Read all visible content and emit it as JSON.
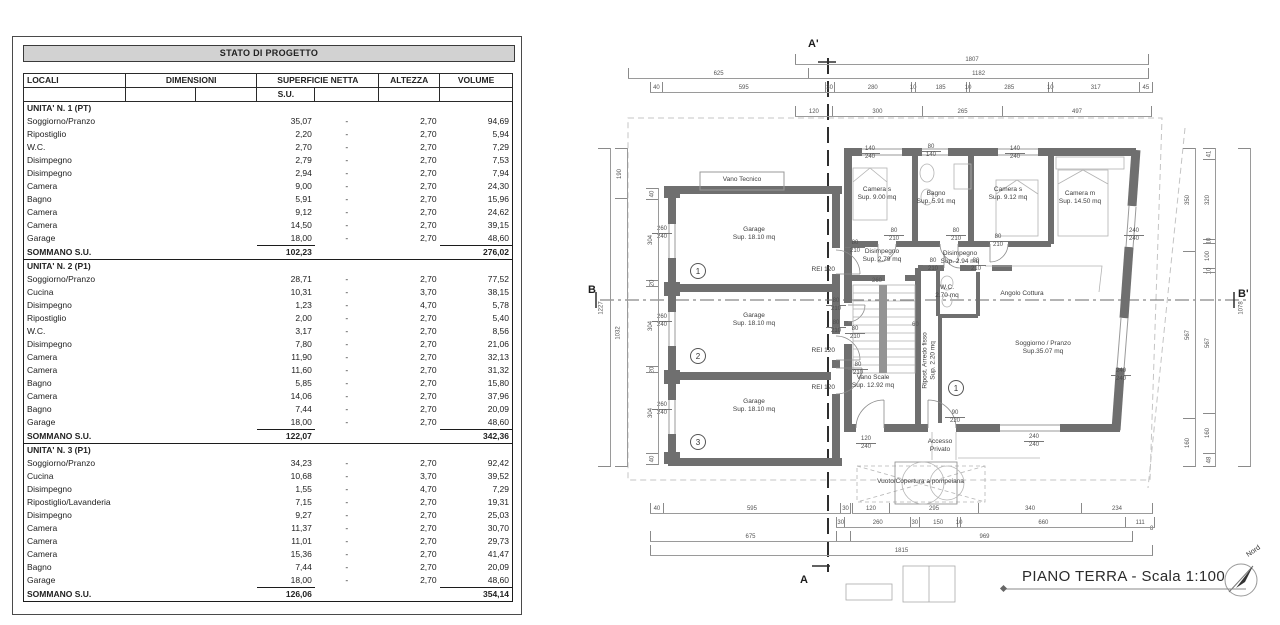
{
  "colors": {
    "wall": "#6f6f6f",
    "table_header_bg": "#d2d2d2",
    "boundary": "#c4c4c4"
  },
  "table": {
    "title": "STATO DI PROGETTO",
    "headers": {
      "locali": "LOCALI",
      "dimensioni": "DIMENSIONI",
      "superficie": "SUPERFICIE NETTA",
      "su": "S.U.",
      "altezza": "ALTEZZA",
      "volume": "VOLUME",
      "sommano": "SOMMANO S.U."
    },
    "groups": [
      {
        "name": "UNITA' N. 1 (PT)",
        "rows": [
          [
            "Soggiorno/Pranzo",
            "35,07",
            "-",
            "2,70",
            "94,69"
          ],
          [
            "Ripostiglio",
            "2,20",
            "-",
            "2,70",
            "5,94"
          ],
          [
            "W.C.",
            "2,70",
            "-",
            "2,70",
            "7,29"
          ],
          [
            "Disimpegno",
            "2,79",
            "-",
            "2,70",
            "7,53"
          ],
          [
            "Disimpegno",
            "2,94",
            "-",
            "2,70",
            "7,94"
          ],
          [
            "Camera",
            "9,00",
            "-",
            "2,70",
            "24,30"
          ],
          [
            "Bagno",
            "5,91",
            "-",
            "2,70",
            "15,96"
          ],
          [
            "Camera",
            "9,12",
            "-",
            "2,70",
            "24,62"
          ],
          [
            "Camera",
            "14,50",
            "-",
            "2,70",
            "39,15"
          ],
          [
            "Garage",
            "18,00",
            "-",
            "2,70",
            "48,60"
          ]
        ],
        "total_su": "102,23",
        "total_volume": "276,02"
      },
      {
        "name": "UNITA' N. 2 (P1)",
        "rows": [
          [
            "Soggiorno/Pranzo",
            "28,71",
            "-",
            "2,70",
            "77,52"
          ],
          [
            "Cucina",
            "10,31",
            "-",
            "3,70",
            "38,15"
          ],
          [
            "Disimpegno",
            "1,23",
            "-",
            "4,70",
            "5,78"
          ],
          [
            "Ripostiglio",
            "2,00",
            "-",
            "2,70",
            "5,40"
          ],
          [
            "W.C.",
            "3,17",
            "-",
            "2,70",
            "8,56"
          ],
          [
            "Disimpegno",
            "7,80",
            "-",
            "2,70",
            "21,06"
          ],
          [
            "Camera",
            "11,90",
            "-",
            "2,70",
            "32,13"
          ],
          [
            "Camera",
            "11,60",
            "-",
            "2,70",
            "31,32"
          ],
          [
            "Bagno",
            "5,85",
            "-",
            "2,70",
            "15,80"
          ],
          [
            "Camera",
            "14,06",
            "-",
            "2,70",
            "37,96"
          ],
          [
            "Bagno",
            "7,44",
            "-",
            "2,70",
            "20,09"
          ],
          [
            "Garage",
            "18,00",
            "-",
            "2,70",
            "48,60"
          ]
        ],
        "total_su": "122,07",
        "total_volume": "342,36"
      },
      {
        "name": "UNITA' N. 3 (P1)",
        "rows": [
          [
            "Soggiorno/Pranzo",
            "34,23",
            "-",
            "2,70",
            "92,42"
          ],
          [
            "Cucina",
            "10,68",
            "-",
            "3,70",
            "39,52"
          ],
          [
            "Disimpegno",
            "1,55",
            "-",
            "4,70",
            "7,29"
          ],
          [
            "Ripostiglio/Lavanderia",
            "7,15",
            "-",
            "2,70",
            "19,31"
          ],
          [
            "Disimpegno",
            "9,27",
            "-",
            "2,70",
            "25,03"
          ],
          [
            "Camera",
            "11,37",
            "-",
            "2,70",
            "30,70"
          ],
          [
            "Camera",
            "11,01",
            "-",
            "2,70",
            "29,73"
          ],
          [
            "Camera",
            "15,36",
            "-",
            "2,70",
            "41,47"
          ],
          [
            "Bagno",
            "7,44",
            "-",
            "2,70",
            "20,09"
          ],
          [
            "Garage",
            "18,00",
            "-",
            "2,70",
            "48,60"
          ]
        ],
        "total_su": "126,06",
        "total_volume": "354,14"
      }
    ]
  },
  "plan": {
    "title": "PIANO TERRA - Scala 1:100",
    "north": "Nord",
    "markers": {
      "a_top": "A'",
      "a_bottom": "A",
      "b_left": "B",
      "b_right": "B'"
    },
    "fire_label": "REI 120",
    "unit_badges": [
      "1",
      "2",
      "3"
    ],
    "entry_badge": "1",
    "rooms": [
      {
        "name": "Camera s",
        "sup": "Sup. 9.00 mq"
      },
      {
        "name": "Bagno",
        "sup": "Sup. 5.91 mq"
      },
      {
        "name": "Camera s",
        "sup": "Sup. 9.12 mq"
      },
      {
        "name": "Camera m",
        "sup": "Sup. 14.50 mq"
      },
      {
        "name": "Disimpegno",
        "sup": "Sup. 2.79 mq"
      },
      {
        "name": "Disimpegno",
        "sup": "Sup. 2.94 mq"
      },
      {
        "name": "W.C.",
        "sup": "2.70 mq"
      },
      {
        "name": "Angolo Cottura",
        "sup": ""
      },
      {
        "name": "Soggiorno / Pranzo",
        "sup": "Sup.35.07 mq"
      },
      {
        "name": "Vano Scale",
        "sup": "Sup. 12.92 mq"
      },
      {
        "name": "Ripost. Arredo fisso",
        "sup": "Sup. 2.20 mq"
      },
      {
        "name": "Garage",
        "sup": "Sup. 18.10 mq"
      },
      {
        "name": "Garage",
        "sup": "Sup. 18.10 mq"
      },
      {
        "name": "Garage",
        "sup": "Sup. 18.10 mq"
      },
      {
        "name": "Vano Tecnico",
        "sup": ""
      },
      {
        "name": "Accesso",
        "sup": "Privato"
      },
      {
        "name": "Vuoto/Copertura a pompeiana",
        "sup": ""
      }
    ],
    "callouts": [
      {
        "t": "140",
        "b": "240"
      },
      {
        "t": "80",
        "b": "140"
      },
      {
        "t": "140",
        "b": "240"
      },
      {
        "t": "260",
        "b": "240"
      },
      {
        "t": "260",
        "b": "240"
      },
      {
        "t": "260",
        "b": "240"
      },
      {
        "t": "80",
        "b": "210"
      },
      {
        "t": "80",
        "b": "210"
      },
      {
        "t": "80",
        "b": "210"
      },
      {
        "t": "80",
        "b": "210"
      },
      {
        "t": "80",
        "b": "210"
      },
      {
        "t": "80",
        "b": "210"
      },
      {
        "t": "80",
        "b": "210"
      },
      {
        "t": "80",
        "b": "210"
      },
      {
        "t": "80",
        "b": "210"
      },
      {
        "t": "80",
        "b": "210"
      },
      {
        "t": "240",
        "b": "240"
      },
      {
        "t": "240",
        "b": "240"
      },
      {
        "t": "240",
        "b": "240"
      },
      {
        "t": "120",
        "b": "240"
      },
      {
        "t": "90",
        "b": "220"
      }
    ],
    "small_dims": {
      "stair_width": "260",
      "stair_gap": "60",
      "edge": "8"
    },
    "dims": {
      "top1": [
        "1807"
      ],
      "top2": [
        "625",
        "1182"
      ],
      "top3": [
        "40",
        "595",
        "30",
        "280",
        "10",
        "185",
        "10",
        "285",
        "10",
        "317",
        "45"
      ],
      "top4": [
        "120",
        "300",
        "265",
        "497"
      ],
      "bottom1l": [
        "40",
        "595",
        "30"
      ],
      "bottom1": [
        "120",
        "295",
        "340",
        "234"
      ],
      "bottom2": [
        "30",
        "260",
        "30",
        "150",
        "10",
        "660",
        "111"
      ],
      "bottom3l": [
        "675"
      ],
      "bottom3": [
        "969"
      ],
      "bottom4": [
        "1815"
      ],
      "left1": [
        "1227"
      ],
      "left2": [
        "190",
        "1032"
      ],
      "left3": [
        "40",
        "304",
        "20",
        "304",
        "20",
        "304",
        "40"
      ],
      "right1": [
        "350",
        "567",
        "160"
      ],
      "right2": [
        "41",
        "320",
        "10",
        "100",
        "10",
        "567",
        "160",
        "48"
      ],
      "right3": [
        "1078"
      ]
    }
  }
}
